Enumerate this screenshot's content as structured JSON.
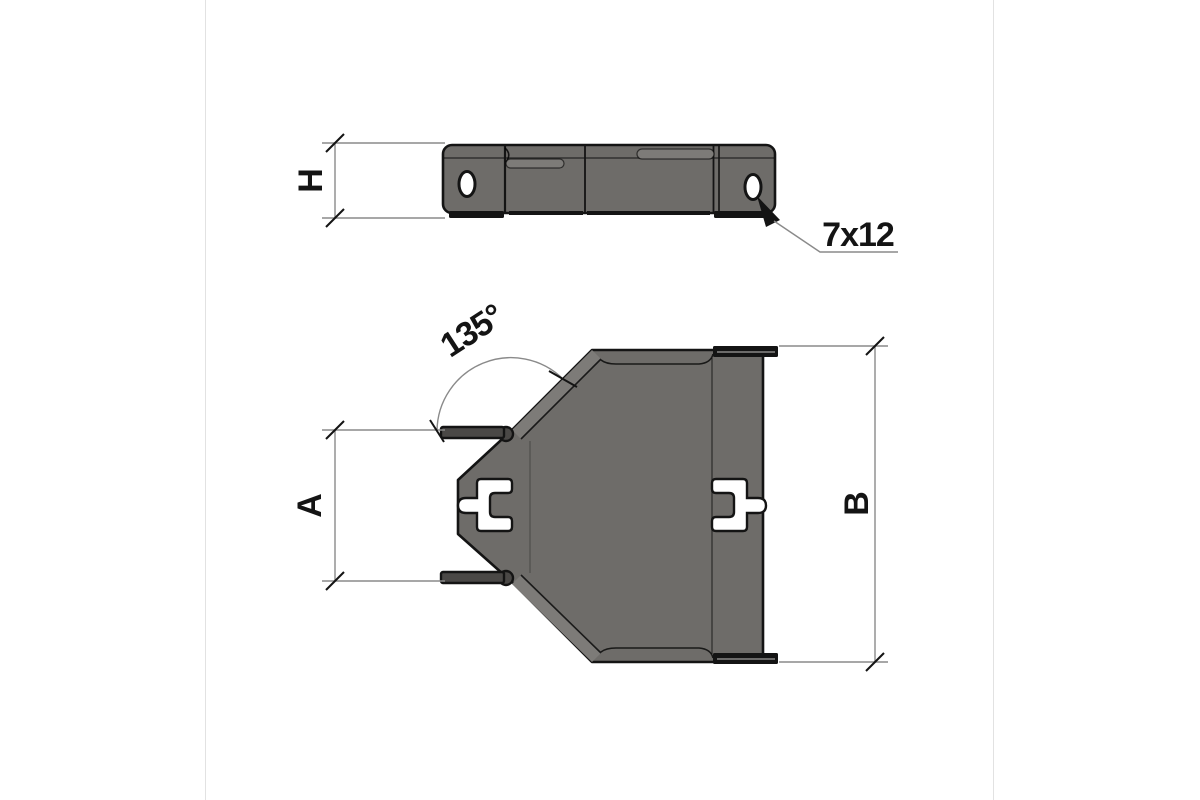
{
  "drawing": {
    "labels": {
      "height": "H",
      "width_small": "A",
      "width_large": "B",
      "slot_size": "7x12",
      "bend_angle": "135°"
    },
    "colors": {
      "background": "#ffffff",
      "body": "#6e6c69",
      "body_light": "#7d7b78",
      "flange": "#4a4846",
      "outline": "#141414",
      "dimension_line": "#8a8a8a"
    }
  }
}
